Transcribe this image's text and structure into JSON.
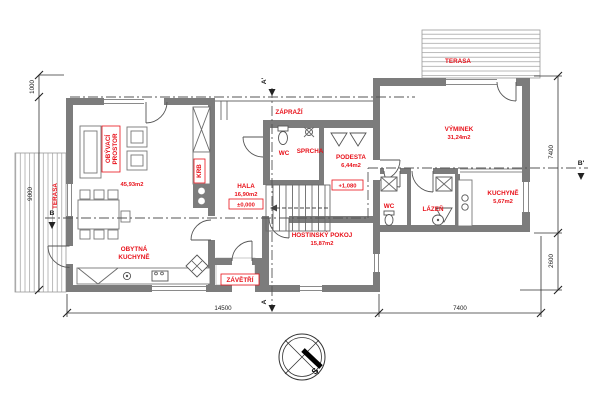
{
  "drawing": {
    "rooms": {
      "obyvaci_line1": "OBÝVACÍ",
      "obyvaci_line2": "PROSTOR",
      "obyvaci_area": "45,93m2",
      "obytna_line1": "OBYTNÁ",
      "obytna_line2": "KUCHYNĚ",
      "krb": "KRB",
      "hala": "HALA",
      "hala_area": "16,90m2",
      "hala_level": "±0,000",
      "zaprazi": "ZÁPRAŽÍ",
      "wc_stred": "WC",
      "sprcha": "SPRCHA",
      "podesta": "PODESTA",
      "podesta_area": "6,44m2",
      "podesta_level": "+1,080",
      "hostinsky": "HOSTINSKÝ POKOJ",
      "hostinsky_area": "15,87m2",
      "zavetri": "ZÁVĚTŘÍ",
      "vyminek": "VÝMINEK",
      "vyminek_area": "31,24m2",
      "wc_pravy": "WC",
      "lazen": "LÁZEŇ",
      "kuchyne": "KUCHYNĚ",
      "kuchyne_area": "5,67m2",
      "terasa_leva": "TERASA",
      "terasa_prava": "TERASA"
    },
    "dimensions": {
      "bottom_left": "14500",
      "bottom_right": "7400",
      "right_top": "7400",
      "right_bottom": "2600",
      "left_top": "1000",
      "left_bottom": "9000"
    },
    "sections": {
      "a_top": "A'",
      "a_bottom": "A",
      "b_left": "B",
      "b_right": "B'"
    },
    "compass_south": "S"
  }
}
